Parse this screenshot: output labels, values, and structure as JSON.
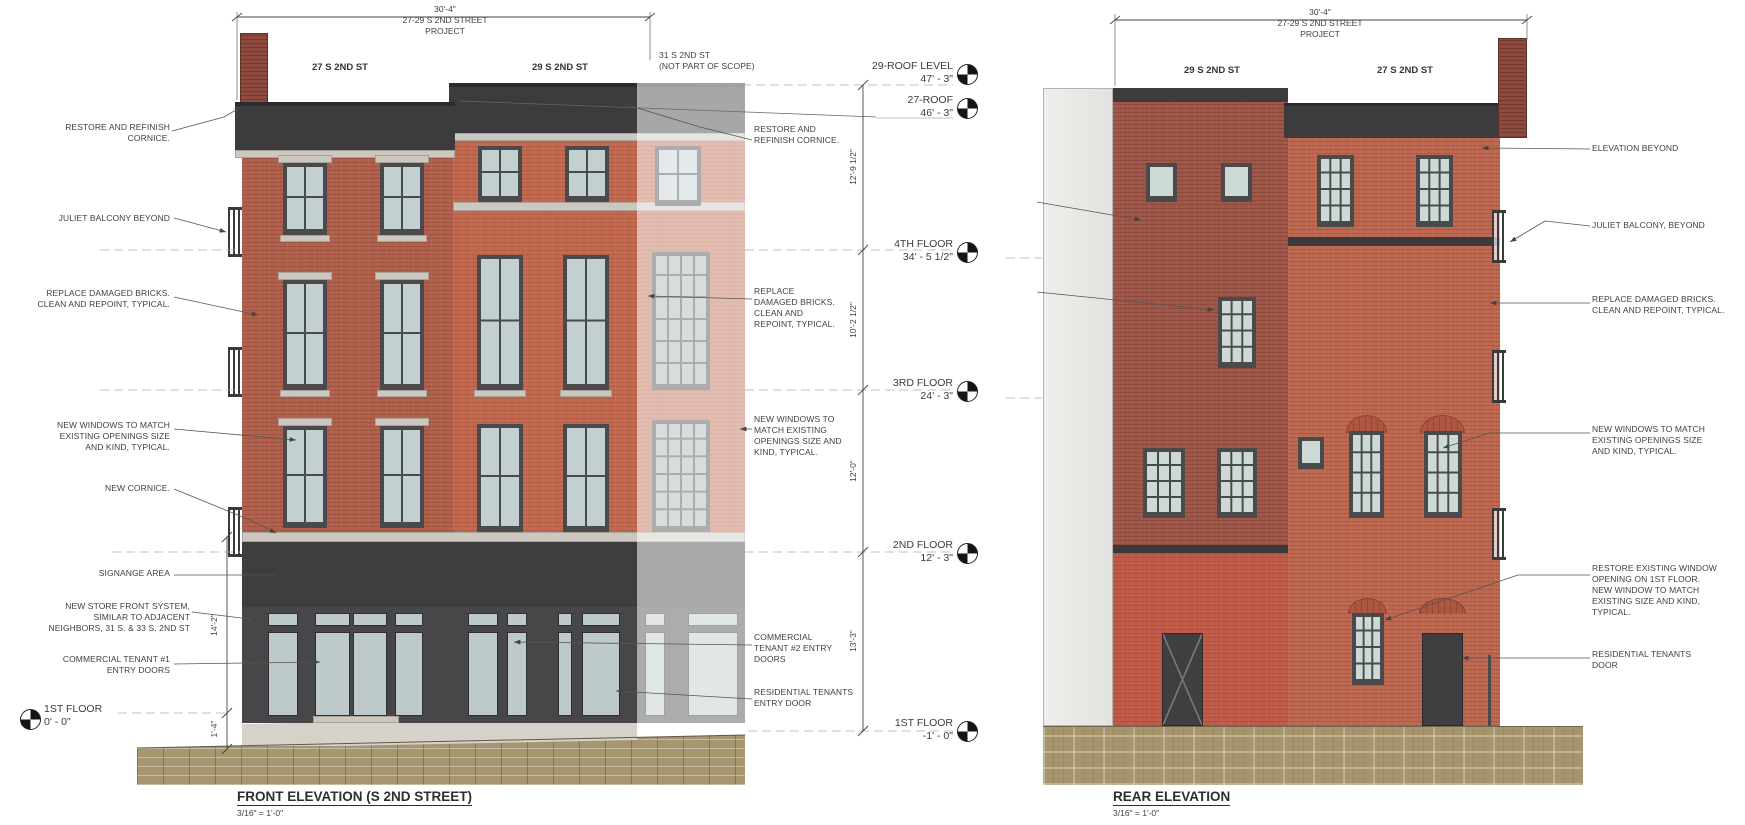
{
  "front": {
    "title": "FRONT ELEVATION (S 2ND STREET)",
    "scale": "3/16\" = 1'-0\"",
    "dim_total": "30'-4\"",
    "dim_label": "27-29 S 2ND STREET\nPROJECT",
    "bldg27_label": "27 S 2ND ST",
    "bldg29_label": "29 S 2ND ST",
    "bldg31_label": "31 S 2ND ST\n(NOT PART OF SCOPE)",
    "left_notes": [
      "RESTORE AND REFINISH\nCORNICE.",
      "JULIET BALCONY BEYOND",
      "REPLACE DAMAGED BRICKS.\nCLEAN AND REPOINT, TYPICAL.",
      "NEW WINDOWS TO MATCH\nEXISTING OPENINGS SIZE\nAND KIND, TYPICAL.",
      "NEW CORNICE.",
      "SIGNANGE AREA",
      "NEW STORE FRONT SYSTEM,\nSIMILAR TO ADJACENT\nNEIGHBORS,  31 S. & 33 S. 2ND ST",
      "COMMERCIAL TENANT #1\nENTRY DOORS"
    ],
    "right_notes": [
      "RESTORE AND\nREFINISH CORNICE.",
      "REPLACE\nDAMAGED BRICKS.\nCLEAN AND\nREPOINT, TYPICAL.",
      "NEW WINDOWS TO\nMATCH EXISTING\nOPENINGS SIZE AND\nKIND, TYPICAL.",
      "COMMERCIAL\nTENANT #2 ENTRY\nDOORS",
      "RESIDENTIAL TENANTS\nENTRY DOOR"
    ],
    "levels": [
      {
        "name": "29-ROOF LEVEL",
        "value": "47' - 3\""
      },
      {
        "name": "27-ROOF",
        "value": "46' - 3\""
      },
      {
        "name": "4TH FLOOR",
        "value": "34' - 5 1/2\""
      },
      {
        "name": "3RD FLOOR",
        "value": "24' - 3\""
      },
      {
        "name": "2ND FLOOR",
        "value": "12' - 3\""
      },
      {
        "name": "1ST FLOOR",
        "value": "-1' - 0\""
      }
    ],
    "left_level": {
      "name": "1ST FLOOR",
      "value": "0' - 0\""
    },
    "vdims_right": [
      "12'-9 1/2\"",
      "10'-2 1/2\"",
      "12'-0\"",
      "13'-3\""
    ],
    "vdims_left": [
      "14'-2\"",
      "1'-4\""
    ]
  },
  "rear": {
    "title": "REAR ELEVATION",
    "scale": "3/16\" = 1'-0\"",
    "dim_total": "30'-4\"",
    "dim_label": "27-29 S 2ND STREET\nPROJECT",
    "bldg29_label": "29 S 2ND ST",
    "bldg27_label": "27 S 2ND ST",
    "right_notes": [
      "ELEVATION BEYOND",
      "JULIET BALCONY, BEYOND",
      "REPLACE DAMAGED BRICKS.\nCLEAN AND REPOINT, TYPICAL.",
      "NEW WINDOWS TO MATCH\nEXISTING OPENINGS SIZE\nAND KIND, TYPICAL.",
      "RESTORE EXISTING WINDOW\nOPENING ON 1ST FLOOR.\nNEW WINDOW TO MATCH\nEXISTING SIZE AND KIND,\nTYPICAL.",
      "RESIDENTIAL TENANTS\nDOOR"
    ]
  }
}
